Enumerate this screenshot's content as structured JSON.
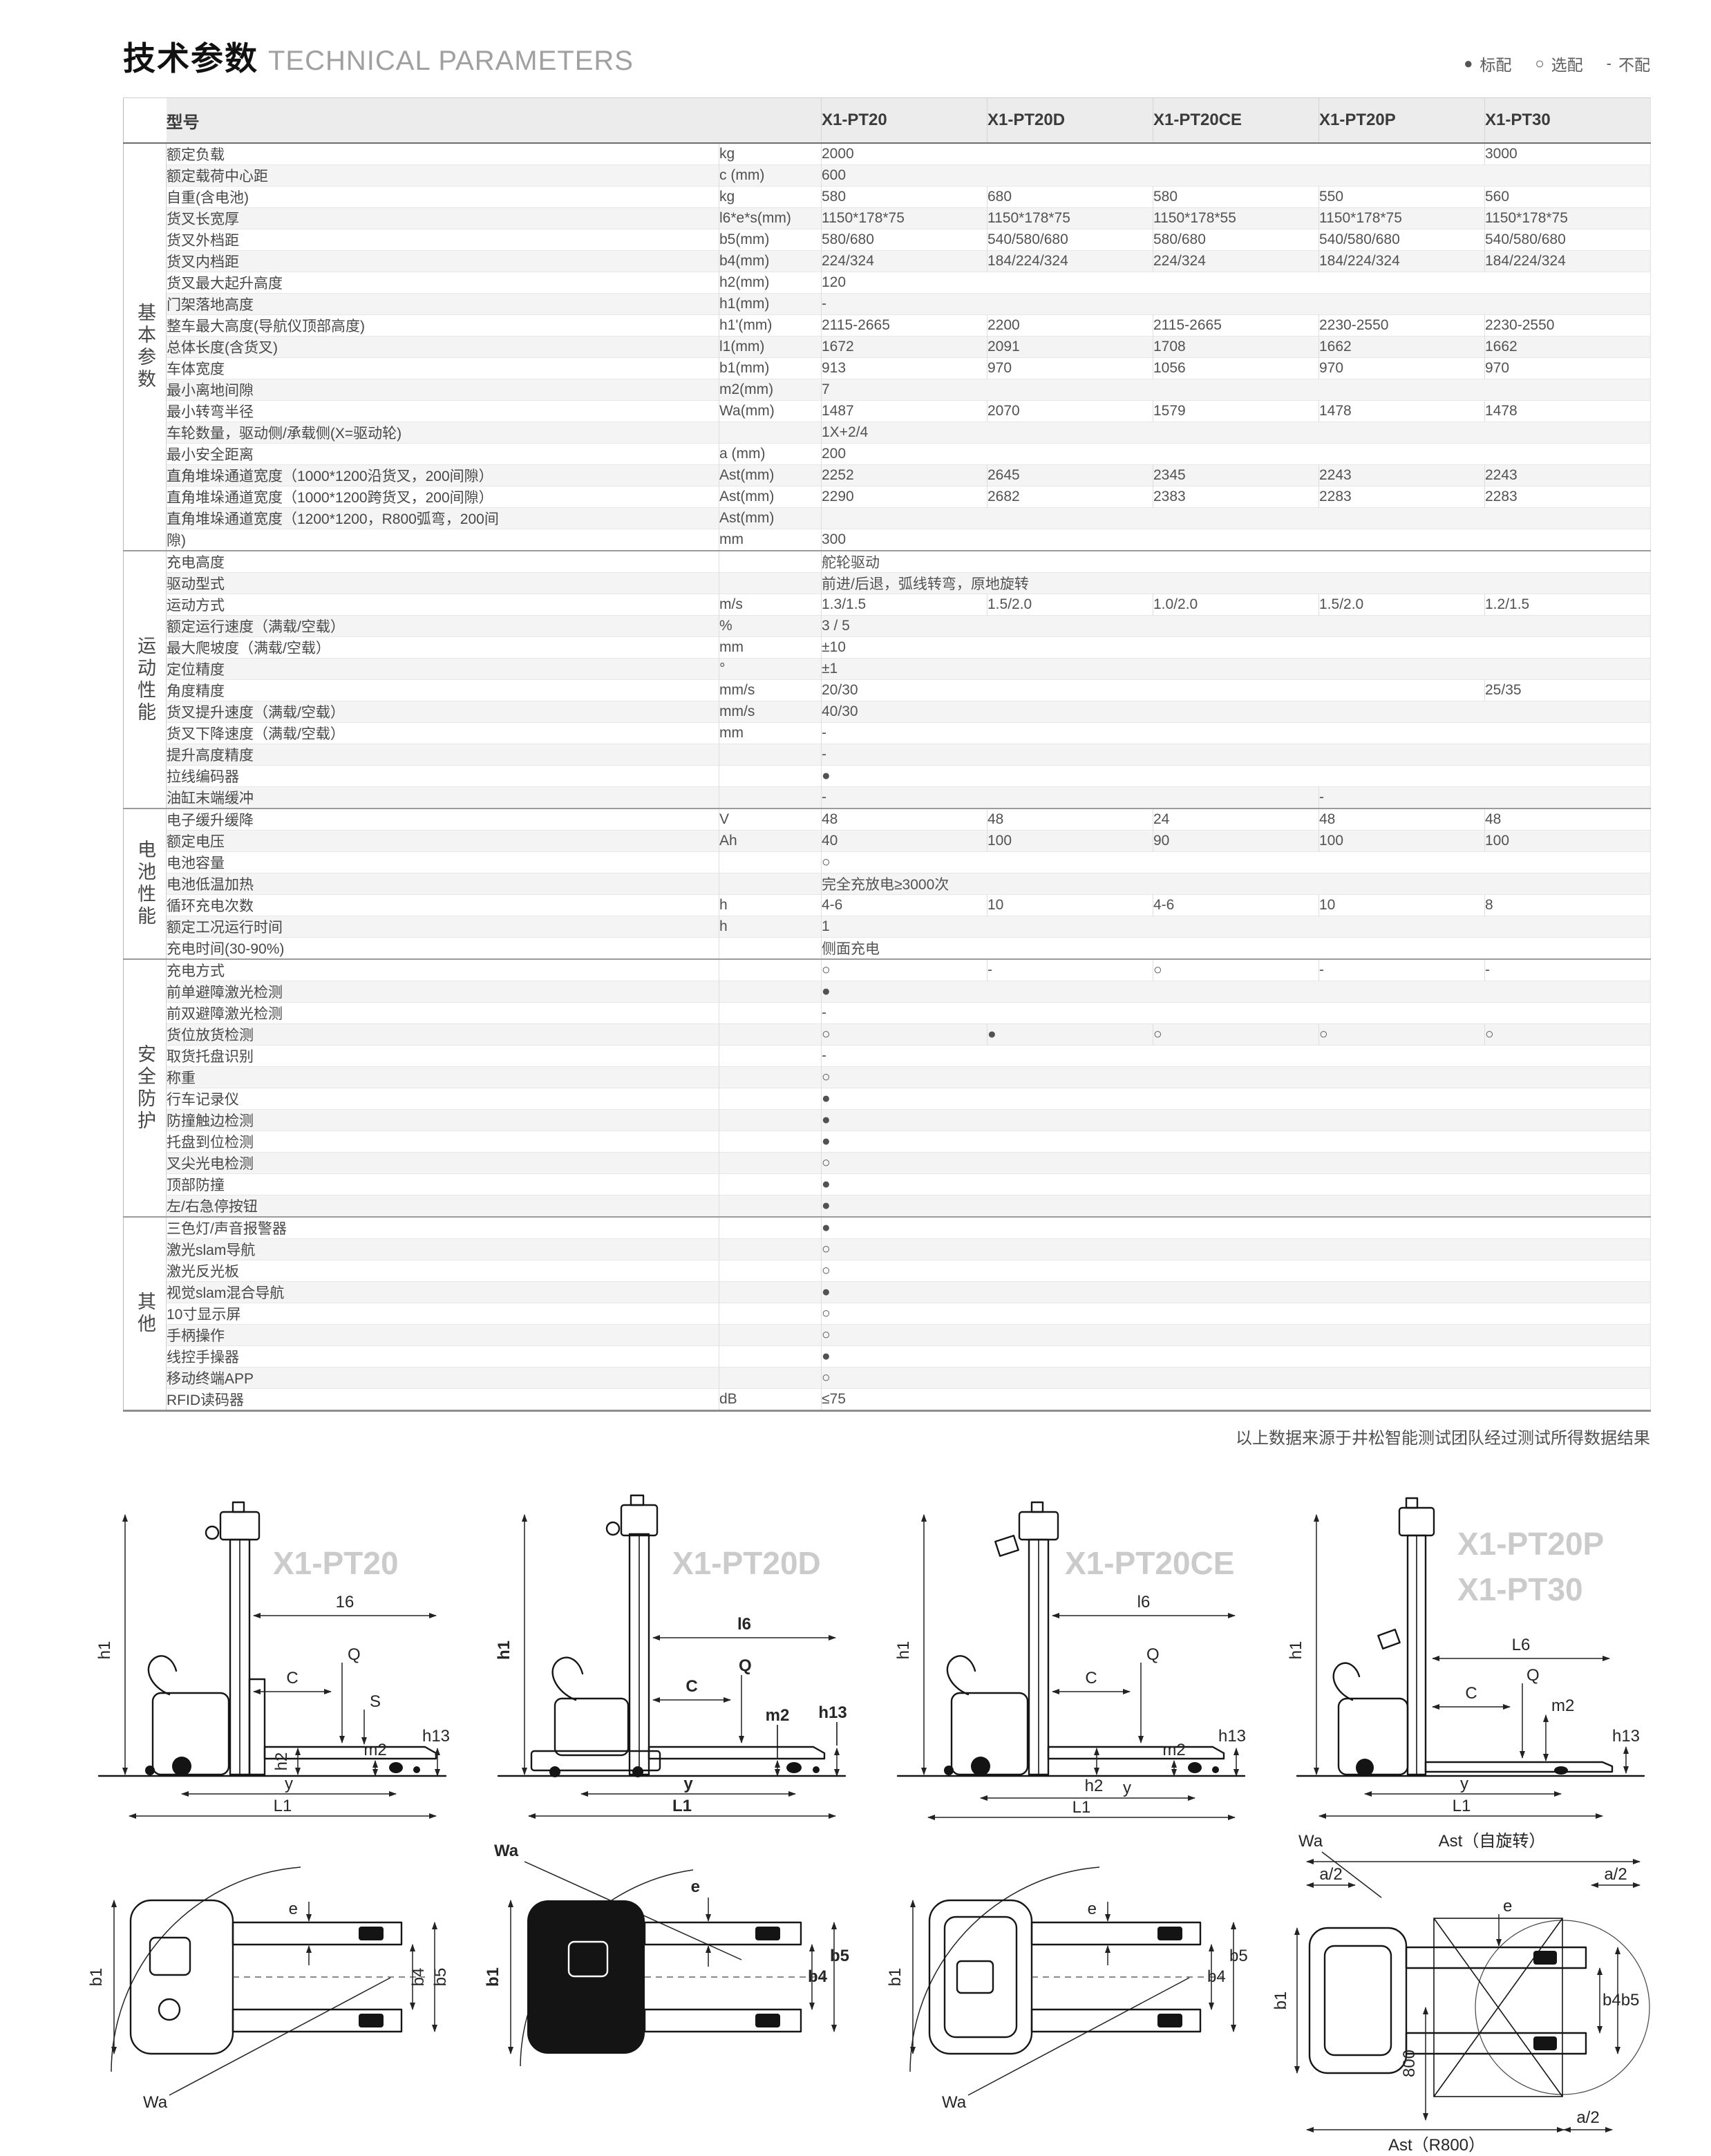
{
  "page": {
    "title_zh": "技术参数",
    "title_en": "TECHNICAL PARAMETERS",
    "legend": [
      {
        "symbol": "●",
        "label": "标配"
      },
      {
        "symbol": "○",
        "label": "选配"
      },
      {
        "symbol": "-",
        "label": "不配"
      }
    ],
    "footnote": "以上数据来源于井松智能测试团队经过测试所得数据结果"
  },
  "table": {
    "model_header_label": "型号",
    "models": [
      "X1-PT20",
      "X1-PT20D",
      "X1-PT20CE",
      "X1-PT20P",
      "X1-PT30"
    ],
    "sections": [
      {
        "group": "基本参数",
        "rows": [
          {
            "l": "额定负载",
            "u": "kg",
            "c": [
              [
                "2000",
                4
              ],
              [
                "3000",
                1
              ]
            ]
          },
          {
            "l": "额定载荷中心距",
            "u": "c (mm)",
            "c": [
              [
                "600",
                5
              ]
            ]
          },
          {
            "l": "自重(含电池)",
            "u": "kg",
            "c": [
              [
                "580",
                1
              ],
              [
                "680",
                1
              ],
              [
                "580",
                1
              ],
              [
                "550",
                1
              ],
              [
                "560",
                1
              ]
            ]
          },
          {
            "l": "货叉长宽厚",
            "u": "l6*e*s(mm)",
            "c": [
              [
                "1150*178*75",
                1
              ],
              [
                "1150*178*75",
                1
              ],
              [
                "1150*178*55",
                1
              ],
              [
                "1150*178*75",
                1
              ],
              [
                "1150*178*75",
                1
              ]
            ]
          },
          {
            "l": "货叉外档距",
            "u": "b5(mm)",
            "c": [
              [
                "580/680",
                1
              ],
              [
                "540/580/680",
                1
              ],
              [
                "580/680",
                1
              ],
              [
                "540/580/680",
                1
              ],
              [
                "540/580/680",
                1
              ]
            ]
          },
          {
            "l": "货叉内档距",
            "u": "b4(mm)",
            "c": [
              [
                "224/324",
                1
              ],
              [
                "184/224/324",
                1
              ],
              [
                "224/324",
                1
              ],
              [
                "184/224/324",
                1
              ],
              [
                "184/224/324",
                1
              ]
            ]
          },
          {
            "l": "货叉最大起升高度",
            "u": "h2(mm)",
            "c": [
              [
                "120",
                5
              ]
            ]
          },
          {
            "l": "门架落地高度",
            "u": "h1(mm)",
            "c": [
              [
                "-",
                5
              ]
            ]
          },
          {
            "l": "整车最大高度(导航仪顶部高度)",
            "u": "h1'(mm)",
            "c": [
              [
                "2115-2665",
                1
              ],
              [
                "2200",
                1
              ],
              [
                "2115-2665",
                1
              ],
              [
                "2230-2550",
                1
              ],
              [
                "2230-2550",
                1
              ]
            ]
          },
          {
            "l": "总体长度(含货叉)",
            "u": "l1(mm)",
            "c": [
              [
                "1672",
                1
              ],
              [
                "2091",
                1
              ],
              [
                "1708",
                1
              ],
              [
                "1662",
                1
              ],
              [
                "1662",
                1
              ]
            ]
          },
          {
            "l": "车体宽度",
            "u": "b1(mm)",
            "c": [
              [
                "913",
                1
              ],
              [
                "970",
                1
              ],
              [
                "1056",
                1
              ],
              [
                "970",
                1
              ],
              [
                "970",
                1
              ]
            ]
          },
          {
            "l": "最小离地间隙",
            "u": "m2(mm)",
            "c": [
              [
                "7",
                5
              ]
            ]
          },
          {
            "l": "最小转弯半径",
            "u": "Wa(mm)",
            "c": [
              [
                "1487",
                1
              ],
              [
                "2070",
                1
              ],
              [
                "1579",
                1
              ],
              [
                "1478",
                1
              ],
              [
                "1478",
                1
              ]
            ]
          },
          {
            "l": "车轮数量，驱动侧/承载侧(X=驱动轮)",
            "u": "",
            "c": [
              [
                "1X+2/4",
                5
              ]
            ]
          },
          {
            "l": "最小安全距离",
            "u": "a (mm)",
            "c": [
              [
                "200",
                5
              ]
            ]
          },
          {
            "l": "直角堆垛通道宽度（1000*1200沿货叉，200间隙）",
            "u": "Ast(mm)",
            "c": [
              [
                "2252",
                1
              ],
              [
                "2645",
                1
              ],
              [
                "2345",
                1
              ],
              [
                "2243",
                1
              ],
              [
                "2243",
                1
              ]
            ]
          },
          {
            "l": "直角堆垛通道宽度（1000*1200跨货叉，200间隙）",
            "u": "Ast(mm)",
            "c": [
              [
                "2290",
                1
              ],
              [
                "2682",
                1
              ],
              [
                "2383",
                1
              ],
              [
                "2283",
                1
              ],
              [
                "2283",
                1
              ]
            ]
          },
          {
            "l": "直角堆垛通道宽度（1200*1200，R800弧弯，200间",
            "u": "Ast(mm)",
            "c": [
              [
                "",
                5
              ]
            ]
          },
          {
            "l": "隙)",
            "u": "mm",
            "c": [
              [
                "300",
                5
              ]
            ]
          }
        ]
      },
      {
        "group": "运动性能",
        "rows": [
          {
            "l": "充电高度",
            "u": "",
            "c": [
              [
                "舵轮驱动",
                5
              ]
            ]
          },
          {
            "l": "驱动型式",
            "u": "",
            "c": [
              [
                "前进/后退，弧线转弯，原地旋转",
                5
              ]
            ]
          },
          {
            "l": "运动方式",
            "u": "m/s",
            "c": [
              [
                "1.3/1.5",
                1
              ],
              [
                "1.5/2.0",
                1
              ],
              [
                "1.0/2.0",
                1
              ],
              [
                "1.5/2.0",
                1
              ],
              [
                "1.2/1.5",
                1
              ]
            ]
          },
          {
            "l": "额定运行速度（满载/空载）",
            "u": "%",
            "c": [
              [
                "3 / 5",
                5
              ]
            ]
          },
          {
            "l": "最大爬坡度（满载/空载）",
            "u": "mm",
            "c": [
              [
                "±10",
                5
              ]
            ]
          },
          {
            "l": "定位精度",
            "u": "°",
            "c": [
              [
                "±1",
                5
              ]
            ]
          },
          {
            "l": "角度精度",
            "u": "mm/s",
            "c": [
              [
                "20/30",
                4
              ],
              [
                "25/35",
                1
              ]
            ]
          },
          {
            "l": "货叉提升速度（满载/空载）",
            "u": "mm/s",
            "c": [
              [
                "40/30",
                5
              ]
            ]
          },
          {
            "l": "货叉下降速度（满载/空载）",
            "u": "mm",
            "c": [
              [
                "-",
                5
              ]
            ]
          },
          {
            "l": "提升高度精度",
            "u": "",
            "c": [
              [
                "-",
                5
              ]
            ]
          },
          {
            "l": "拉线编码器",
            "u": "",
            "c": [
              [
                "●",
                5
              ]
            ]
          },
          {
            "l": "油缸末端缓冲",
            "u": "",
            "c": [
              [
                "-",
                3
              ],
              [
                "-",
                1
              ],
              [
                "",
                1
              ]
            ]
          }
        ]
      },
      {
        "group": "电池性能",
        "rows": [
          {
            "l": "电子缓升缓降",
            "u": "V",
            "c": [
              [
                "48",
                1
              ],
              [
                "48",
                1
              ],
              [
                "24",
                1
              ],
              [
                "48",
                1
              ],
              [
                "48",
                1
              ]
            ]
          },
          {
            "l": "额定电压",
            "u": "Ah",
            "c": [
              [
                "40",
                1
              ],
              [
                "100",
                1
              ],
              [
                "90",
                1
              ],
              [
                "100",
                1
              ],
              [
                "100",
                1
              ]
            ]
          },
          {
            "l": "电池容量",
            "u": "",
            "c": [
              [
                "○",
                5
              ]
            ]
          },
          {
            "l": "电池低温加热",
            "u": "",
            "c": [
              [
                "完全充放电≥3000次",
                5
              ]
            ]
          },
          {
            "l": "循环充电次数",
            "u": "h",
            "c": [
              [
                "4-6",
                1
              ],
              [
                "10",
                1
              ],
              [
                "4-6",
                1
              ],
              [
                "10",
                1
              ],
              [
                "8",
                1
              ]
            ]
          },
          {
            "l": "额定工况运行时间",
            "u": "h",
            "c": [
              [
                "1",
                5
              ]
            ]
          },
          {
            "l": "充电时间(30-90%)",
            "u": "",
            "c": [
              [
                "侧面充电",
                5
              ]
            ]
          }
        ]
      },
      {
        "group": "安全防护",
        "rows": [
          {
            "l": "充电方式",
            "u": "",
            "c": [
              [
                "○",
                1
              ],
              [
                "-",
                1
              ],
              [
                "○",
                1
              ],
              [
                "-",
                1
              ],
              [
                "-",
                1
              ]
            ]
          },
          {
            "l": "前单避障激光检测",
            "u": "",
            "c": [
              [
                "●",
                5
              ]
            ]
          },
          {
            "l": "前双避障激光检测",
            "u": "",
            "c": [
              [
                "-",
                5
              ]
            ]
          },
          {
            "l": "货位放货检测",
            "u": "",
            "c": [
              [
                "○",
                1
              ],
              [
                "●",
                1
              ],
              [
                "○",
                1
              ],
              [
                "○",
                1
              ],
              [
                "○",
                1
              ]
            ]
          },
          {
            "l": "取货托盘识别",
            "u": "",
            "c": [
              [
                "-",
                5
              ]
            ]
          },
          {
            "l": "称重",
            "u": "",
            "c": [
              [
                "○",
                5
              ]
            ]
          },
          {
            "l": "行车记录仪",
            "u": "",
            "c": [
              [
                "●",
                5
              ]
            ]
          },
          {
            "l": "防撞触边检测",
            "u": "",
            "c": [
              [
                "●",
                5
              ]
            ]
          },
          {
            "l": "托盘到位检测",
            "u": "",
            "c": [
              [
                "●",
                5
              ]
            ]
          },
          {
            "l": "叉尖光电检测",
            "u": "",
            "c": [
              [
                "○",
                5
              ]
            ]
          },
          {
            "l": "顶部防撞",
            "u": "",
            "c": [
              [
                "●",
                5
              ]
            ]
          },
          {
            "l": "左/右急停按钮",
            "u": "",
            "c": [
              [
                "●",
                5
              ]
            ]
          }
        ]
      },
      {
        "group": "其他",
        "rows": [
          {
            "l": "三色灯/声音报警器",
            "u": "",
            "c": [
              [
                "●",
                5
              ]
            ]
          },
          {
            "l": "激光slam导航",
            "u": "",
            "c": [
              [
                "○",
                5
              ]
            ]
          },
          {
            "l": "激光反光板",
            "u": "",
            "c": [
              [
                "○",
                5
              ]
            ]
          },
          {
            "l": "视觉slam混合导航",
            "u": "",
            "c": [
              [
                "●",
                5
              ]
            ]
          },
          {
            "l": "10寸显示屏",
            "u": "",
            "c": [
              [
                "○",
                5
              ]
            ]
          },
          {
            "l": "手柄操作",
            "u": "",
            "c": [
              [
                "○",
                5
              ]
            ]
          },
          {
            "l": "线控手操器",
            "u": "",
            "c": [
              [
                "●",
                5
              ]
            ]
          },
          {
            "l": "移动终端APP",
            "u": "",
            "c": [
              [
                "○",
                5
              ]
            ]
          },
          {
            "l": "RFID读码器",
            "u": "dB",
            "c": [
              [
                "≤75",
                5
              ]
            ]
          }
        ]
      }
    ]
  },
  "diagrams": {
    "groups": [
      {
        "model": "X1-PT20",
        "model2": "",
        "side": {
          "h1": "h1",
          "len": "16",
          "c": "C",
          "q": "Q",
          "s": "S",
          "h2": "h2",
          "m2": "m2",
          "h13": "h13",
          "y": "y",
          "l1": "L1"
        },
        "top": {
          "b1": "b1",
          "e": "e",
          "b4": "b4",
          "b5": "b5",
          "wa": "Wa"
        }
      },
      {
        "model": "X1-PT20D",
        "model2": "",
        "side": {
          "h1": "h1",
          "len": "l6",
          "c": "C",
          "q": "Q",
          "m2": "m2",
          "h13": "h13",
          "y": "y",
          "l1": "L1"
        },
        "top": {
          "b1": "b1",
          "e": "e",
          "b4": "b4",
          "b5": "b5",
          "wa": "Wa"
        }
      },
      {
        "model": "X1-PT20CE",
        "model2": "",
        "side": {
          "h1": "h1",
          "len": "l6",
          "c": "C",
          "q": "Q",
          "m2": "m2",
          "h2": "h2",
          "h13": "h13",
          "y": "y",
          "l1": "L1"
        },
        "top": {
          "b1": "b1",
          "e": "e",
          "b4": "b4",
          "b5": "b5",
          "wa": "Wa"
        }
      },
      {
        "model": "X1-PT20P",
        "model2": "X1-PT30",
        "side": {
          "h1": "h1",
          "len": "L6",
          "c": "C",
          "q": "Q",
          "m2": "m2",
          "h13": "h13",
          "y": "y",
          "l1": "L1"
        },
        "top": {
          "wa": "Wa",
          "ast_self": "Ast（自旋转）",
          "a2": "a/2",
          "e": "e",
          "b1": "b1",
          "b45": "b4b5",
          "dim800": "800",
          "ast_r800": "Ast（R800）"
        }
      }
    ]
  }
}
